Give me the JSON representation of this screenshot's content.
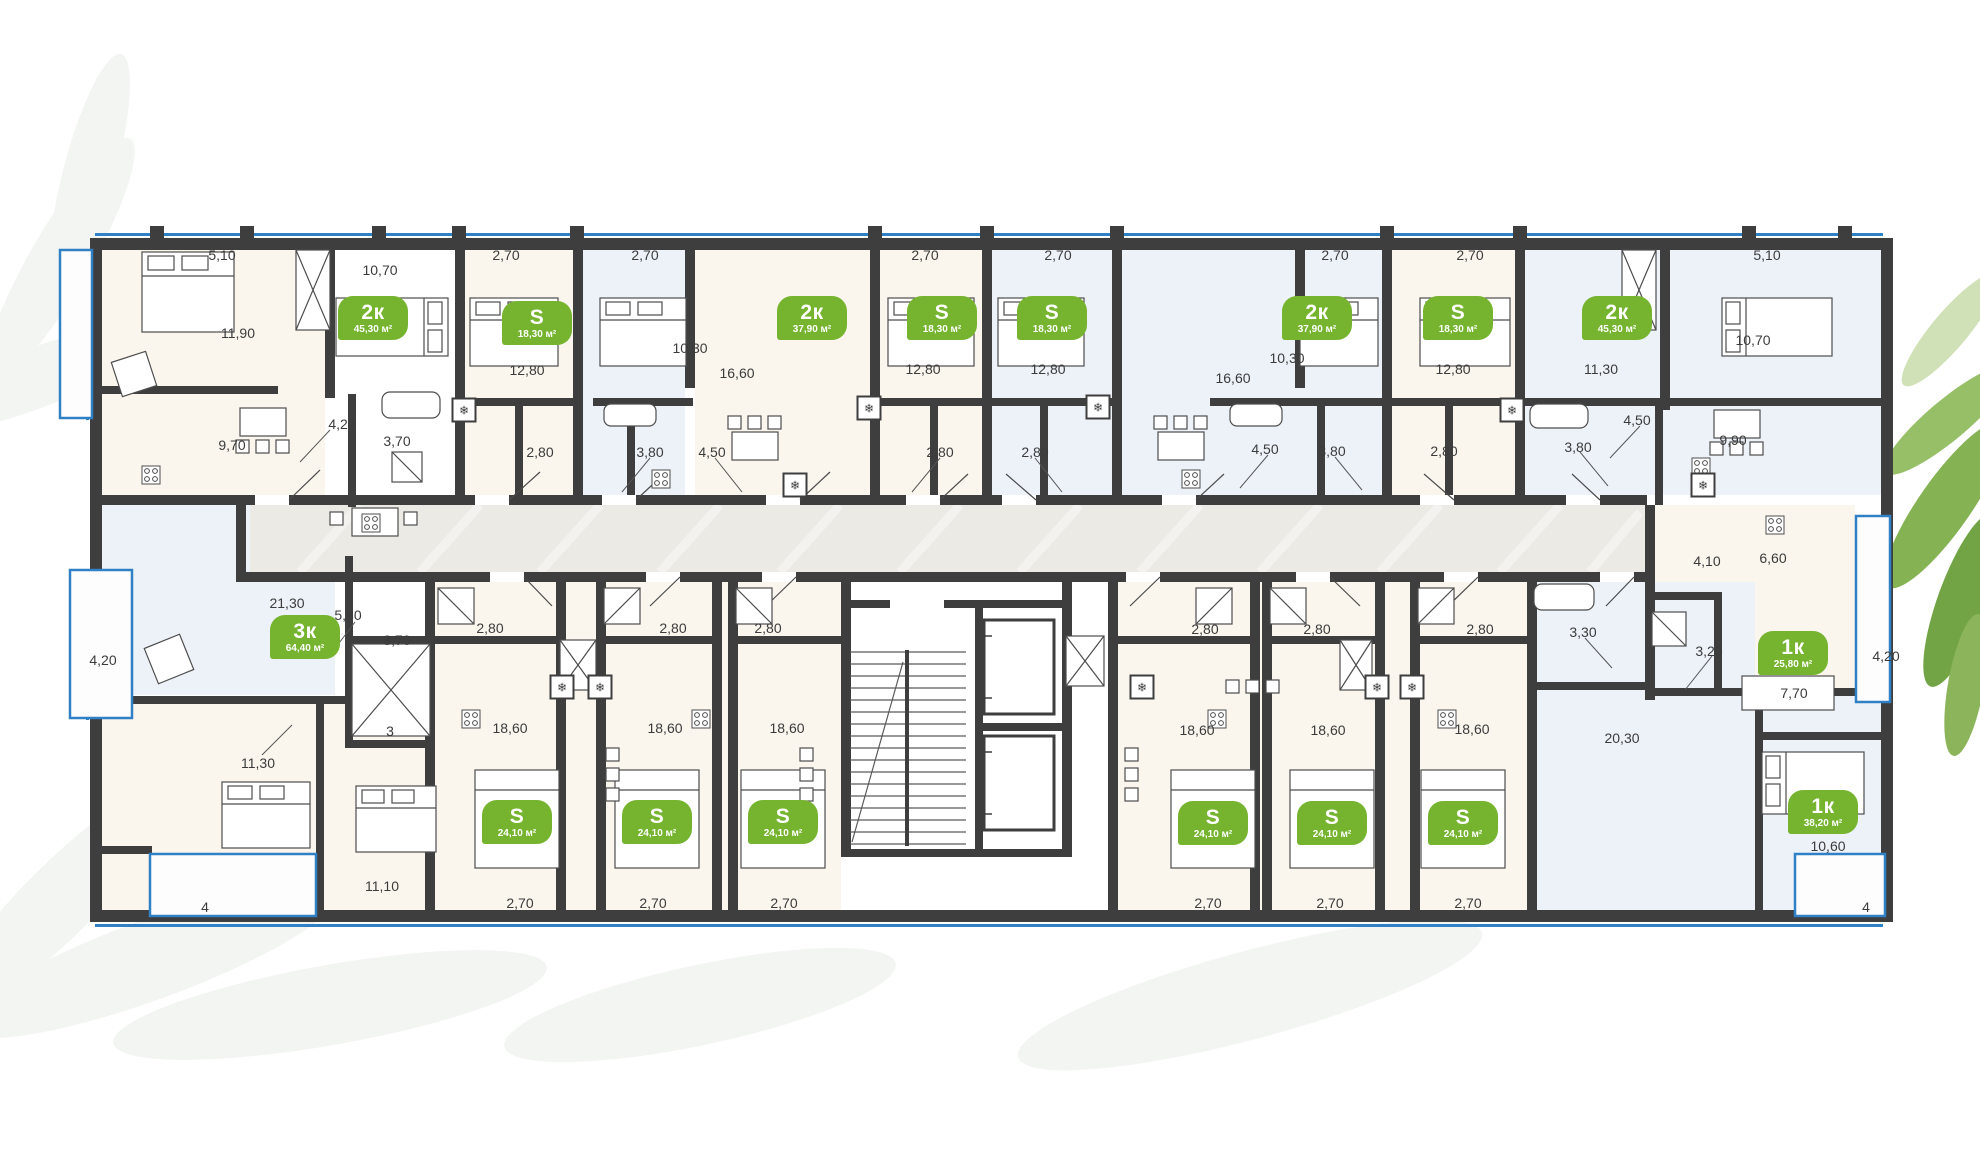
{
  "colors": {
    "tag_green": "#76b430",
    "wall_dark": "#3e3e3e",
    "glazing_blue": "#2f80c5",
    "corridor_gray": "#eceae5",
    "tint_cream": "#faf6ee",
    "tint_blue": "#edf2f9"
  },
  "icons": {
    "ac_unit_glyph": "❄"
  },
  "apartments": [
    {
      "type": "2к",
      "area": "45,30 м²",
      "x": 373,
      "y": 318
    },
    {
      "type": "S",
      "area": "18,30 м²",
      "x": 537,
      "y": 323
    },
    {
      "type": "2к",
      "area": "37,90 м²",
      "x": 812,
      "y": 318
    },
    {
      "type": "S",
      "area": "18,30 м²",
      "x": 942,
      "y": 318
    },
    {
      "type": "S",
      "area": "18,30 м²",
      "x": 1052,
      "y": 318
    },
    {
      "type": "2к",
      "area": "37,90 м²",
      "x": 1317,
      "y": 318
    },
    {
      "type": "S",
      "area": "18,30 м²",
      "x": 1458,
      "y": 318
    },
    {
      "type": "2к",
      "area": "45,30 м²",
      "x": 1617,
      "y": 318
    },
    {
      "type": "3к",
      "area": "64,40 м²",
      "x": 305,
      "y": 637
    },
    {
      "type": "S",
      "area": "24,10 м²",
      "x": 517,
      "y": 822
    },
    {
      "type": "S",
      "area": "24,10 м²",
      "x": 657,
      "y": 822
    },
    {
      "type": "S",
      "area": "24,10 м²",
      "x": 783,
      "y": 822
    },
    {
      "type": "S",
      "area": "24,10 м²",
      "x": 1213,
      "y": 823
    },
    {
      "type": "S",
      "area": "24,10 м²",
      "x": 1332,
      "y": 823
    },
    {
      "type": "S",
      "area": "24,10 м²",
      "x": 1463,
      "y": 823
    },
    {
      "type": "1к",
      "area": "25,80 м²",
      "x": 1793,
      "y": 653
    },
    {
      "type": "1к",
      "area": "38,20 м²",
      "x": 1823,
      "y": 812
    }
  ],
  "dimensions": [
    [
      "5,10",
      222,
      255
    ],
    [
      "2,70",
      506,
      255
    ],
    [
      "2,70",
      645,
      255
    ],
    [
      "2,70",
      925,
      255
    ],
    [
      "2,70",
      1058,
      255
    ],
    [
      "2,70",
      1335,
      255
    ],
    [
      "2,70",
      1470,
      255
    ],
    [
      "5,10",
      1767,
      255
    ],
    [
      "10,70",
      380,
      270
    ],
    [
      "11,90",
      238,
      333
    ],
    [
      "10,30",
      690,
      348
    ],
    [
      "10,30",
      1287,
      358
    ],
    [
      "10,70",
      1753,
      340
    ],
    [
      "11,30",
      1601,
      369
    ],
    [
      "12,80",
      527,
      370
    ],
    [
      "12,80",
      923,
      369
    ],
    [
      "12,80",
      1048,
      369
    ],
    [
      "12,80",
      1453,
      369
    ],
    [
      "16,60",
      737,
      373
    ],
    [
      "16,60",
      1233,
      378
    ],
    [
      "4,20",
      342,
      424
    ],
    [
      "3,70",
      397,
      441
    ],
    [
      "9,70",
      232,
      445
    ],
    [
      "2,80",
      540,
      452
    ],
    [
      "3,80",
      650,
      452
    ],
    [
      "4,50",
      712,
      452
    ],
    [
      "2,80",
      940,
      452
    ],
    [
      "2,80",
      1035,
      452
    ],
    [
      "4,50",
      1265,
      449
    ],
    [
      "3,80",
      1332,
      451
    ],
    [
      "2,80",
      1444,
      451
    ],
    [
      "3,80",
      1578,
      447
    ],
    [
      "4,50",
      1637,
      420
    ],
    [
      "9,90",
      1733,
      440
    ],
    [
      "21,30",
      287,
      603
    ],
    [
      "5,80",
      348,
      615
    ],
    [
      "4,20",
      103,
      660
    ],
    [
      "3,70",
      397,
      640
    ],
    [
      "3",
      390,
      731
    ],
    [
      "11,30",
      258,
      763
    ],
    [
      "11,10",
      382,
      886
    ],
    [
      "4",
      205,
      907
    ],
    [
      "4,10",
      1707,
      561
    ],
    [
      "6,60",
      1773,
      558
    ],
    [
      "3,30",
      1583,
      632
    ],
    [
      "3,20",
      1709,
      651
    ],
    [
      "4,20",
      1886,
      656
    ],
    [
      "7,70",
      1794,
      693
    ],
    [
      "20,30",
      1622,
      738
    ],
    [
      "10,60",
      1828,
      846
    ],
    [
      "4",
      1866,
      907
    ],
    [
      "2,80",
      490,
      628
    ],
    [
      "2,80",
      673,
      628
    ],
    [
      "2,80",
      768,
      628
    ],
    [
      "2,80",
      1205,
      629
    ],
    [
      "2,80",
      1317,
      629
    ],
    [
      "2,80",
      1480,
      629
    ],
    [
      "18,60",
      510,
      728
    ],
    [
      "18,60",
      665,
      728
    ],
    [
      "18,60",
      787,
      728
    ],
    [
      "18,60",
      1197,
      730
    ],
    [
      "18,60",
      1328,
      730
    ],
    [
      "18,60",
      1472,
      729
    ],
    [
      "2,70",
      520,
      903
    ],
    [
      "2,70",
      653,
      903
    ],
    [
      "2,70",
      784,
      903
    ],
    [
      "2,70",
      1208,
      903
    ],
    [
      "2,70",
      1330,
      903
    ],
    [
      "2,70",
      1468,
      903
    ]
  ],
  "ac_units": [
    {
      "x": 464,
      "y": 410
    },
    {
      "x": 869,
      "y": 408
    },
    {
      "x": 1098,
      "y": 407
    },
    {
      "x": 1512,
      "y": 410
    },
    {
      "x": 795,
      "y": 485
    },
    {
      "x": 562,
      "y": 687
    },
    {
      "x": 600,
      "y": 687
    },
    {
      "x": 1142,
      "y": 687
    },
    {
      "x": 1377,
      "y": 687
    },
    {
      "x": 1412,
      "y": 687
    },
    {
      "x": 1703,
      "y": 485
    }
  ]
}
